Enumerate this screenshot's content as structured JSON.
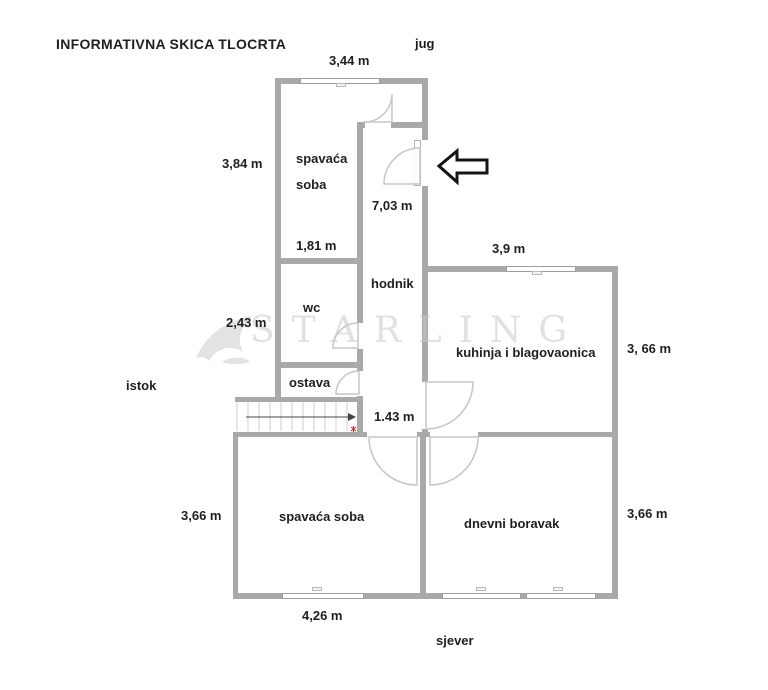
{
  "title": "INFORMATIVNA SKICA TLOCRTA",
  "watermark": {
    "text": "STARLING"
  },
  "compass": {
    "south": "jug",
    "east": "istok",
    "north": "sjever"
  },
  "rooms": {
    "bedroom_top": "spavaća soba",
    "hallway": "hodnik",
    "wc": "wc",
    "pantry": "ostava",
    "kitchen": "kuhinja i blagovaonica",
    "bedroom_bottom": "spavaća soba",
    "living_room": "dnevni boravak"
  },
  "dimensions": {
    "top_width": "3,44 m",
    "bedroom_top_height": "3,84 m",
    "hallway_length": "7,03 m",
    "bedroom_top_width": "1,81 m",
    "kitchen_width": "3,9 m",
    "wc_height": "2,43 m",
    "kitchen_height": "3, 66 m",
    "hallway_width": "1.43 m",
    "bedroom_bottom_height": "3,66 m",
    "living_room_height": "3,66 m",
    "bedroom_bottom_width": "4,26 m"
  },
  "colors": {
    "wall": "#a9a9a9",
    "door_arc": "#c6c6c6",
    "text": "#1f1f1f",
    "watermark": "#dcdcdc",
    "stairs_mark": "#cc2222",
    "entrance_arrow_outline": "#141414"
  }
}
